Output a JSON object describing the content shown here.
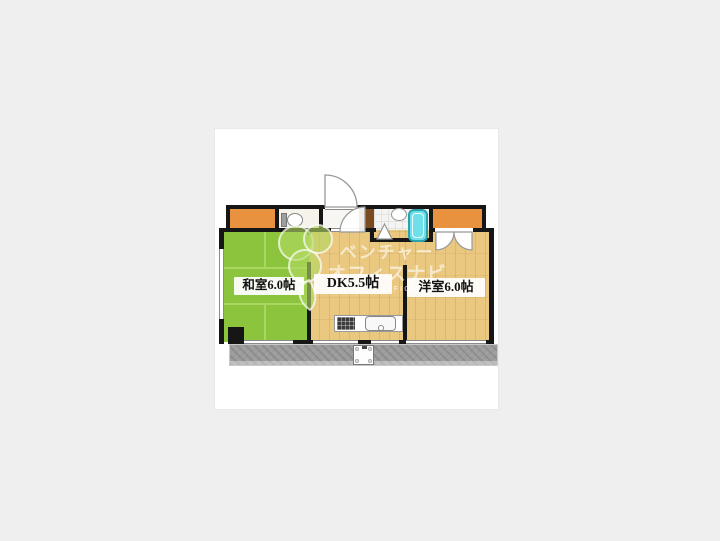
{
  "page": {
    "background": "#efefef",
    "canvas_background": "#ffffff"
  },
  "floor_plan": {
    "rooms": {
      "washitsu": {
        "label": "和室6.0帖",
        "type": "japanese-tatami-room",
        "floor_color": "#8cc43e"
      },
      "dk": {
        "label": "DK5.5帖",
        "type": "dining-kitchen",
        "floor_color": "#eac87f"
      },
      "yoshitsu": {
        "label": "洋室6.0帖",
        "type": "western-room",
        "floor_color": "#eac87f"
      }
    },
    "fixtures": {
      "entrance_door": "entrance-door-swing-icon",
      "interior_door": "interior-door-swing-icon",
      "toilet": "toilet-icon",
      "bathtub": "bathtub-icon",
      "washbasin": "washbasin-icon",
      "bathroom_door": "bathroom-door-triangle-icon",
      "closet_doors": "bifold-closet-door-icon",
      "kitchen_stove": "stove-icon",
      "kitchen_sink": "sink-icon",
      "washing_machine_pan": "washing-machine-pan-icon",
      "balcony": "balcony"
    },
    "colors": {
      "wall": "#161616",
      "tatami_green": "#8cc43e",
      "tatami_line": "#a9d75f",
      "wood_floor": "#eac87f",
      "closet_orange": "#e8913f",
      "wood_wall_brown": "#7c4a1f",
      "bathtub_cyan": "#6fe0e9",
      "balcony_gray": "#9c9c9c"
    },
    "watermark": {
      "logo": "clover-leaf-logo-icon",
      "line1": "ベンチャー",
      "line2": "オフィスナビ",
      "line3": "VENTURE OFFICE NAVI",
      "text_color": "#ffffff"
    }
  }
}
